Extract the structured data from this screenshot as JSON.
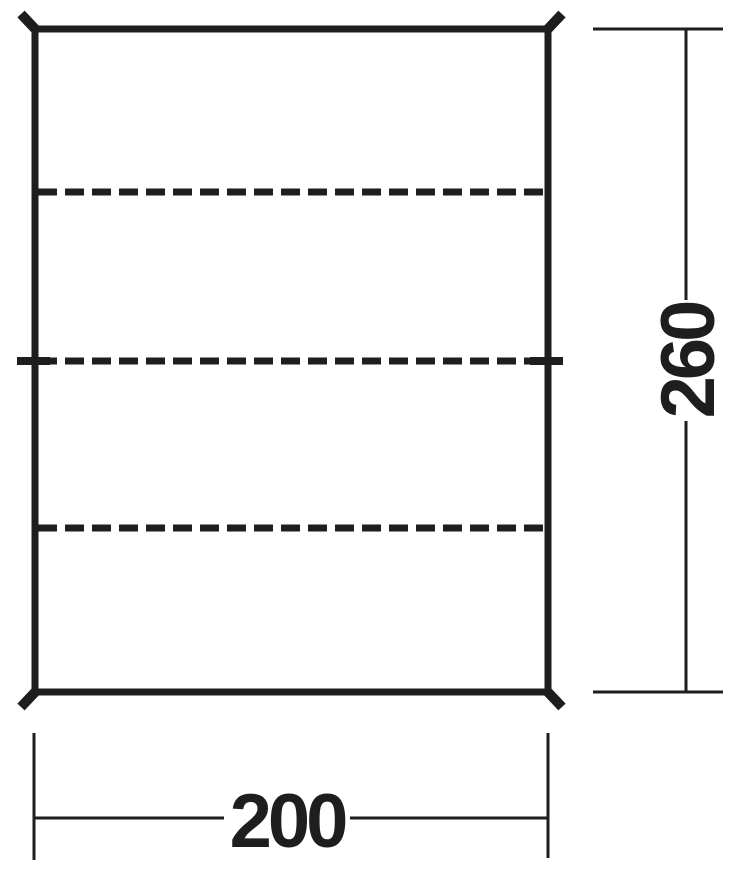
{
  "drawing": {
    "stroke_color": "#1f1e1e",
    "background_color": "#ffffff",
    "sheet": {
      "description": "rectangular sheet shown in top view",
      "corner_tie_marks": 4,
      "dashed_fold_lines": 3,
      "mid_edge_tie_marks": 2
    },
    "dimensions": {
      "width": {
        "value": "200",
        "position": "bottom"
      },
      "height": {
        "value": "260",
        "position": "right",
        "text_rotation_deg": -90
      }
    }
  }
}
